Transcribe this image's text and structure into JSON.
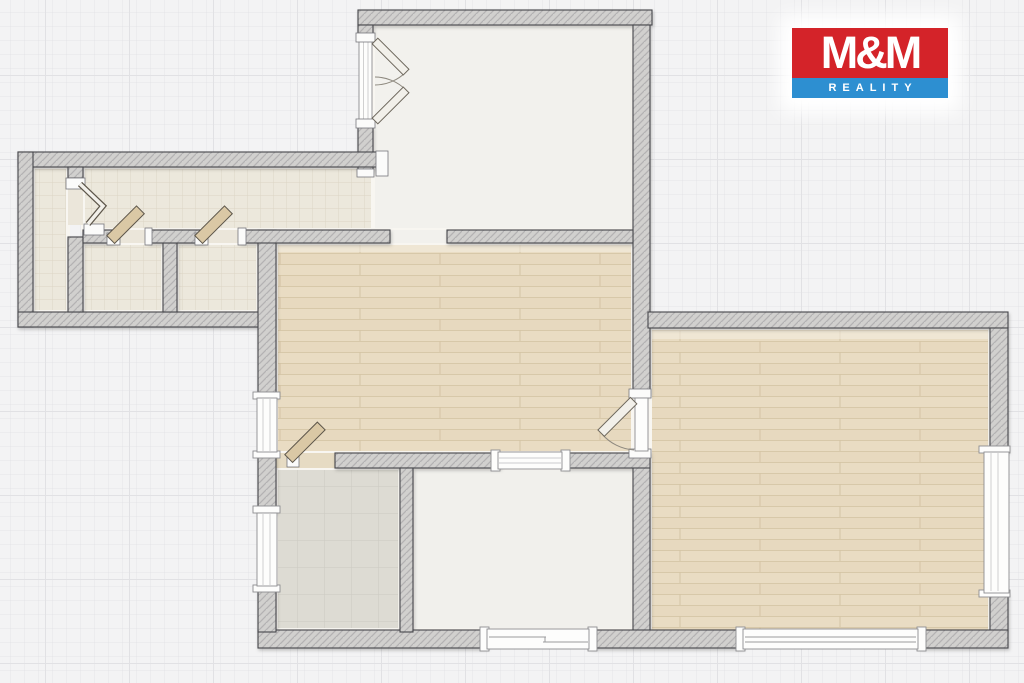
{
  "logo": {
    "top_text": "M&M",
    "bottom_text": "REALITY"
  },
  "colors": {
    "logo_red": "#d42329",
    "logo_blue": "#2d8fd1",
    "logo_text": "#ffffff",
    "background": "#f3f3f4",
    "background_grid_line": "#e1e1e4",
    "wall_fill": "#d1d0ce",
    "wall_outline": "#46464b",
    "wood_floor": "#e9dcc3",
    "wood_floor_line": "#d7c8a9",
    "hall_tile_floor": "#ece8dc",
    "bathroom_tile_floor": "#dddbd3",
    "plain_floor": "#f2f1ed",
    "door_leaf_wood": "#dac8a5",
    "door_leaf_white": "#f2f0ea",
    "window_white": "#fdfdfc"
  }
}
